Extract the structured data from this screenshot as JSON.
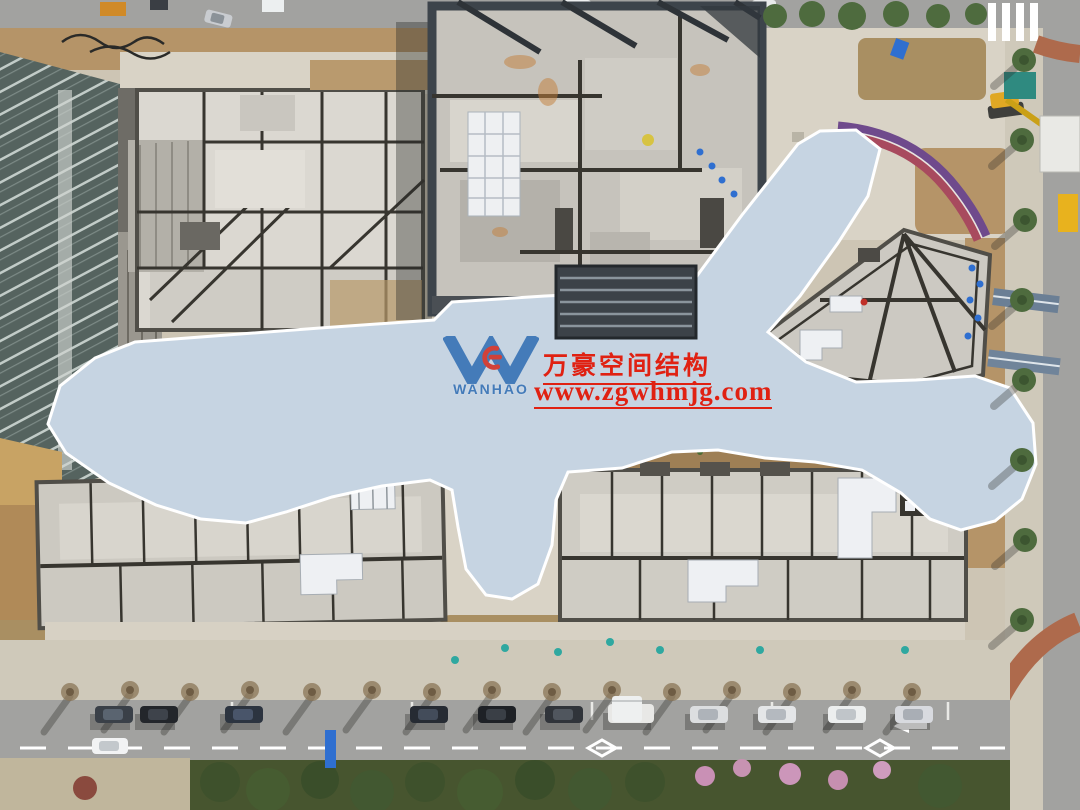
{
  "watermark": {
    "logo": {
      "monogram": "W",
      "brand": "WANHAO",
      "monogram_color": "#2e6cb3",
      "mark_color": "#d4281c"
    },
    "company": "万豪空间结构",
    "website": "www.zgwhmjg.com",
    "text_color": "#e02112"
  },
  "palette": {
    "canopy_base": "#c6d4e2",
    "canopy_cell_hi": "#f8fbfe",
    "canopy_cell_mid": "#e3ebf3",
    "canopy_cell_lo": "#b4c8db",
    "canopy_seam": "#ffffff",
    "concrete_roof": "#cfccc5",
    "concrete_roof_light": "#dbd8d1",
    "roof_joint": "#37352f",
    "parapet": "#504e48",
    "scaffold": "#3d444b",
    "ground": "#cdc5b4",
    "paving_light": "#d9d3c6",
    "dirt": "#b59468",
    "dirt_dark": "#a98f62",
    "asphalt": "#a2a2a0",
    "sidewalk": "#cfc9ba",
    "hedge": "#47552f",
    "tree_green": "#4e6b3e",
    "glass_dark": "#55635f",
    "glass_line": "#cfd8d4",
    "red_paving": "#ae6a4c",
    "track_purple": "#6f4a8c",
    "track_red": "#a84a5e",
    "machine_yellow": "#e0a824",
    "barrel_blue": "#2f6fd0",
    "hvac_silver": "#eef0f3",
    "shadow": "rgba(40,42,40,0.38)"
  }
}
